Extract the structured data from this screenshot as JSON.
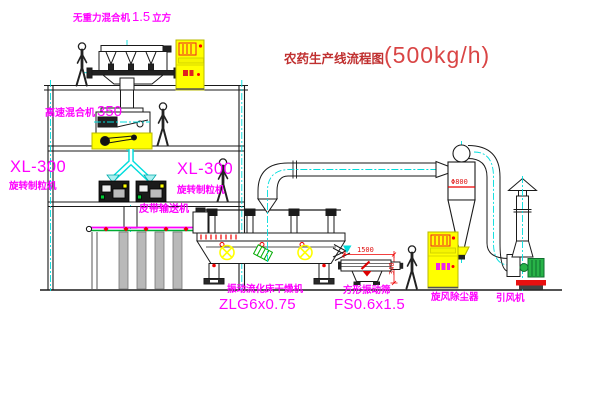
{
  "title": {
    "text_cn": "农药生产线流程图",
    "capacity": "(500kg/h)"
  },
  "equipment_labels": {
    "gravity_mixer": {
      "name": "无重力混合机",
      "size": "1.5",
      "unit": "立方"
    },
    "high_speed_mixer": {
      "name": "高速混合机",
      "model": "350"
    },
    "granulator_left": {
      "model": "XL-300",
      "name": "旋转制粒机"
    },
    "granulator_right": {
      "model": "XL-300",
      "name": "旋转制粒机"
    },
    "belt_conveyor": {
      "name": "皮带输送机"
    },
    "fluid_bed_dryer": {
      "name": "振动流化床干燥机",
      "model": "ZLG6x0.75"
    },
    "vibrating_screen": {
      "name": "方形振动筛",
      "model": "FS0.6x1.5"
    },
    "cyclone": {
      "name": "旋风除尘器"
    },
    "induced_draft_fan": {
      "name": "引风机"
    }
  },
  "dimensions": {
    "cyclone_diameter": "Φ800",
    "screen_length": "1500",
    "screen_height": "340"
  },
  "colors": {
    "label_magenta": "#ff00ff",
    "title_red": "#c03030",
    "equipment_yellow": "#ffff00",
    "centerline_cyan": "#00dddd",
    "fan_green": "#28b348",
    "detail_red": "#e01010"
  }
}
